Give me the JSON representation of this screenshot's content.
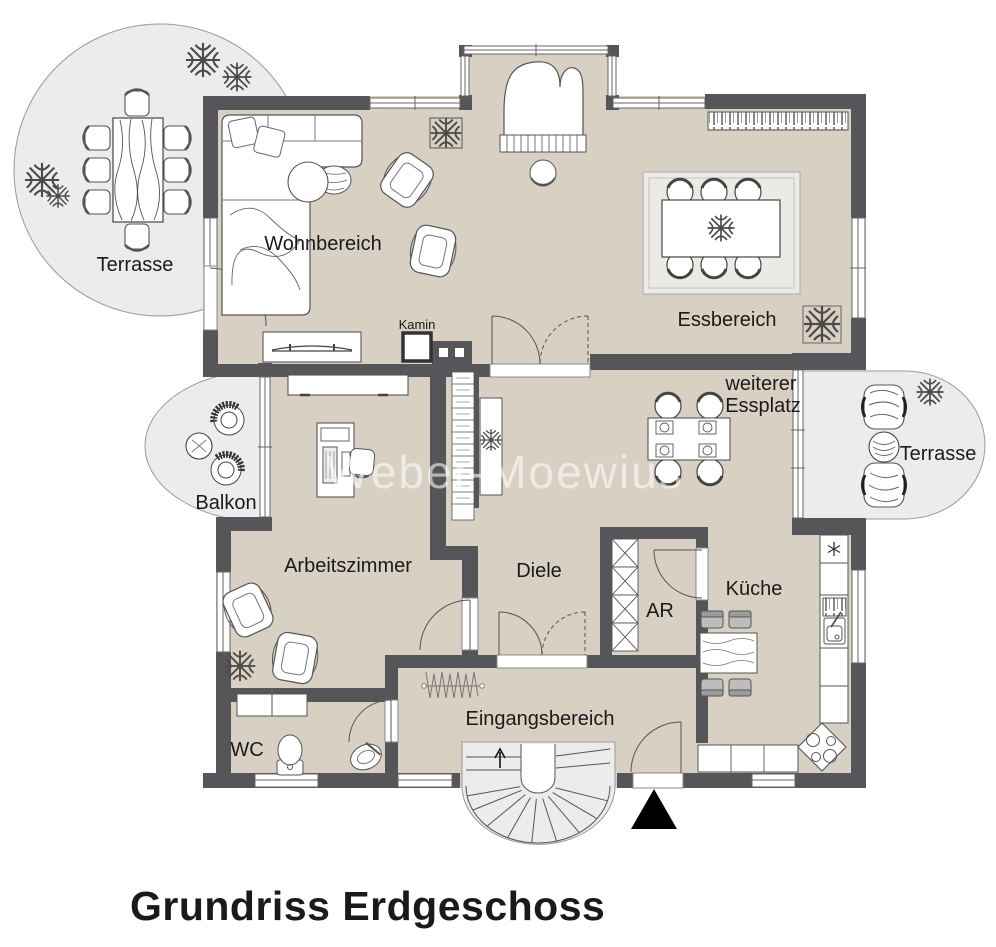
{
  "title": "Grundriss Erdgeschoss",
  "watermark": "Weber-Moewius",
  "rooms": {
    "terrace_left": "Terrasse",
    "living": "Wohnbereich",
    "dining": "Essbereich",
    "fireplace": "Kamin",
    "extra_dining_line1": "weiterer",
    "extra_dining_line2": "Essplatz",
    "terrace_right": "Terrasse",
    "balcony": "Balkon",
    "study": "Arbeitszimmer",
    "hallway": "Diele",
    "storage": "AR",
    "kitchen": "Küche",
    "wc": "WC",
    "entrance": "Eingangsbereich"
  },
  "icons": {
    "plant": "plant-icon",
    "snowflake": "snowflake-icon",
    "entrance_marker": "entrance-triangle-icon",
    "stair_direction": "up-arrow-icon"
  },
  "colors": {
    "wall": "#55555a",
    "floor": "#d8d0c3",
    "outdoor": "#ececec",
    "outline": "#4a4a4a",
    "text": "#1a1a1a",
    "watermark": "#ffffff"
  }
}
